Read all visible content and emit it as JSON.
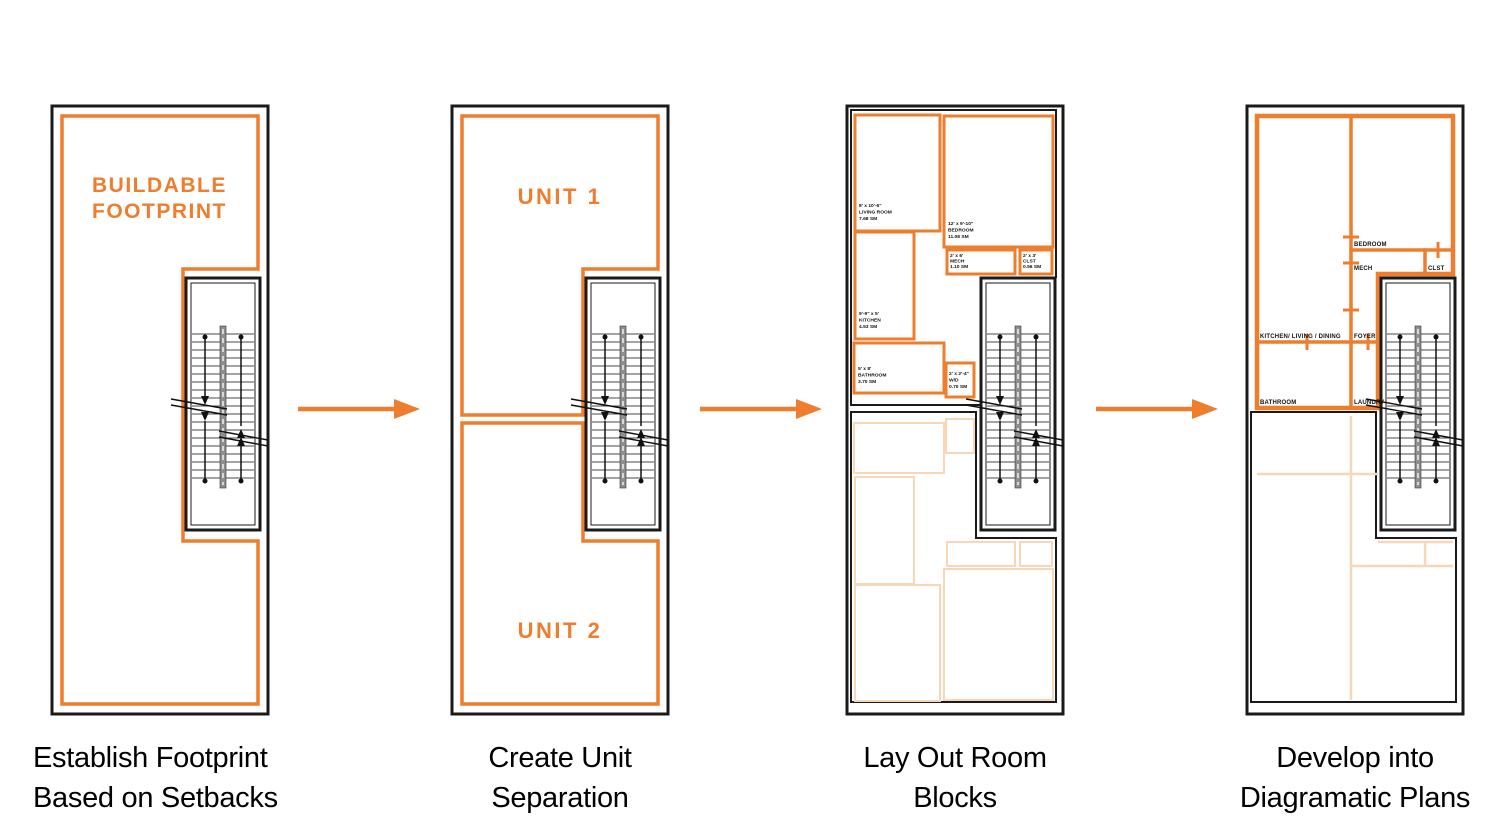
{
  "colors": {
    "orange": "#EE7D2E",
    "orange-faint": "#F8D7B8",
    "line": "#1A1A1A",
    "text": "#000000"
  },
  "captions": [
    [
      "Establish Footprint",
      "Based on Setbacks"
    ],
    [
      "Create Unit",
      "Separation"
    ],
    [
      "Lay Out Room",
      "Blocks"
    ],
    [
      "Develop into",
      "Diagramatic Plans"
    ]
  ],
  "panel1": {
    "label_line1": "BUILDABLE",
    "label_line2": "FOOTPRINT"
  },
  "panel2": {
    "unit1": "UNIT 1",
    "unit2": "UNIT 2"
  },
  "panel3": {
    "blocks": {
      "living": {
        "dim": "8' x 10'-6\"",
        "name": "LIVING ROOM",
        "area": "7.68 SM"
      },
      "bedroom": {
        "dim": "12' x 9'-10\"",
        "name": "BEDROOM",
        "area": "11.08 SM"
      },
      "mech": {
        "dim": "2' x 6'",
        "name": "MECH",
        "area": "1.10 SM"
      },
      "clst": {
        "dim": "2' x 3'",
        "name": "CLST",
        "area": "0.56 SM"
      },
      "kitchen": {
        "dim": "9'-9\" x 5'",
        "name": "KITCHEN",
        "area": "4.53 SM"
      },
      "bathroom": {
        "dim": "5' x 8'",
        "name": "BATHROOM",
        "area": "3.70 SM"
      },
      "wd": {
        "dim": "2' x 2'-4\"",
        "name": "W/D",
        "area": "0.70 SM"
      }
    }
  },
  "panel4": {
    "rooms": {
      "bedroom": "BEDROOM",
      "mech": "MECH",
      "clst": "CLST",
      "kitchen_living_dining": "KITCHEN/ LIVING / DINING",
      "foyer": "FOYER",
      "bathroom": "BATHROOM",
      "laundry": "LAUNDRY"
    }
  }
}
